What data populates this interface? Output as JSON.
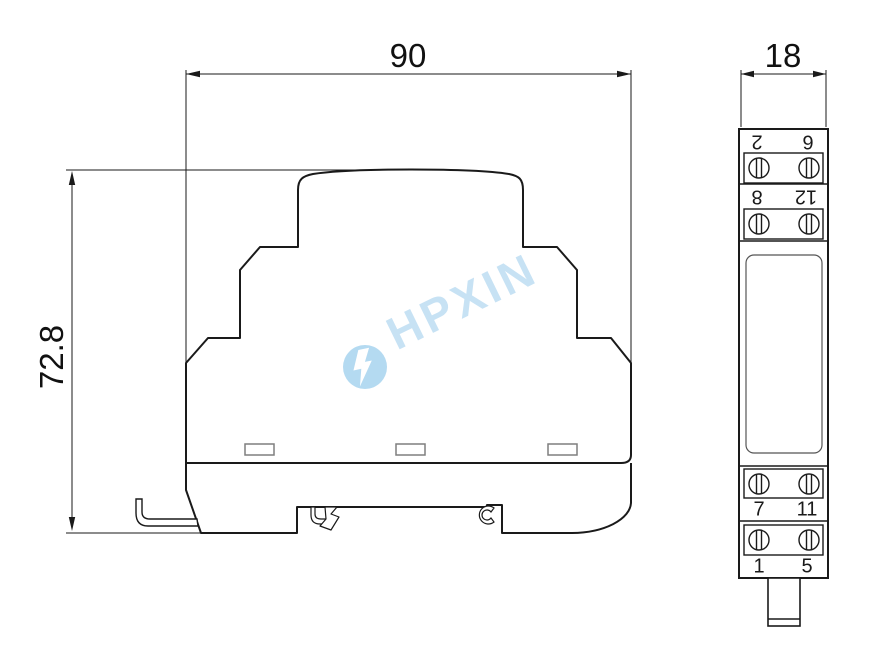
{
  "drawing": {
    "type": "dimensional-outline-drawing",
    "views": [
      "front",
      "side"
    ]
  },
  "front_view": {
    "width_label": "90",
    "height_label": "72.8"
  },
  "side_view": {
    "depth_label": "18",
    "terminal_labels": [
      "2",
      "6",
      "8",
      "12",
      "7",
      "11",
      "1",
      "5"
    ]
  },
  "watermark": {
    "text": "HPXIN"
  },
  "colors": {
    "line": "#1a1a1a",
    "slot_outline": "#7f7f7f",
    "panel_outline": "#555555",
    "watermark_text": "#c7e2f4",
    "watermark_logo": "#b4daf1"
  }
}
